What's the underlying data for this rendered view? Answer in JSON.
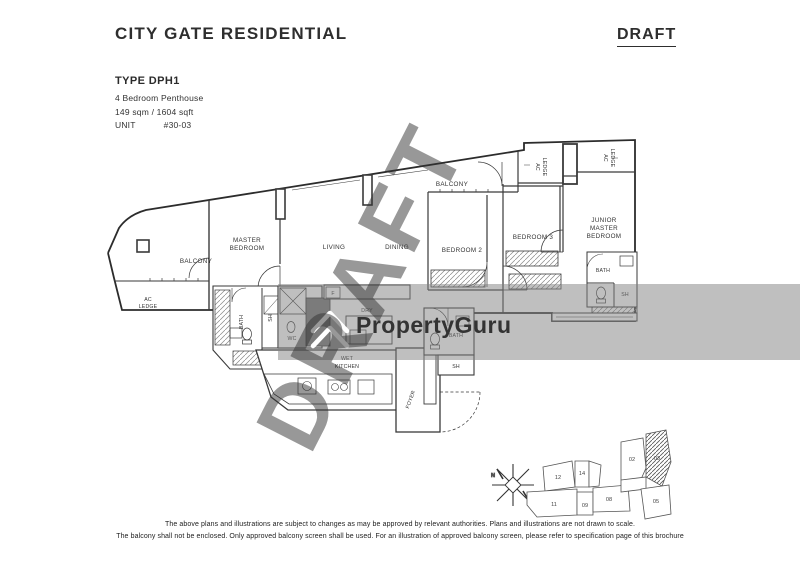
{
  "header": {
    "title": "CITY GATE RESIDENTIAL",
    "draft_label": "DRAFT"
  },
  "unit_info": {
    "type": "TYPE DPH1",
    "description": "4 Bedroom Penthouse",
    "area": "149 sqm / 1604 sqft",
    "unit_label": "UNIT",
    "unit_number": "#30-03"
  },
  "watermark": {
    "brand": "PropertyGuru",
    "draft": "DRAFT",
    "band_color": "#808080"
  },
  "plan": {
    "labels": {
      "balcony_left": "BALCONY",
      "ac_left_line1": "AC",
      "ac_left_line2": "LEDGE",
      "master_line1": "MASTER",
      "master_line2": "BEDROOM",
      "living": "LIVING",
      "dining": "DINING",
      "balcony_top": "BALCONY",
      "bedroom2": "BEDROOM 2",
      "bedroom3": "BEDROOM 3",
      "junior_line1": "JUNIOR",
      "junior_line2": "MASTER",
      "junior_line3": "BEDROOM",
      "ac_top1_line1": "AC",
      "ac_top1_line2": "LEDGE",
      "ac_top2_line1": "AC",
      "ac_top2_line2": "LEDGE",
      "bath_master": "BATH",
      "sh_master": "SH",
      "wc": "WC",
      "dry": "DRY",
      "wet_line1": "WET",
      "wet_line2": "KITCHEN",
      "bath_common": "BATH",
      "sh_common": "SH",
      "foyer": "FOYER",
      "bath_junior": "BATH",
      "sh_junior": "SH",
      "fridge": "F"
    }
  },
  "key_plan": {
    "north_label": "N",
    "units": {
      "u02": "02",
      "u03": "03",
      "u05": "05",
      "u08": "08",
      "u09": "09",
      "u11": "11",
      "u12": "12",
      "u14": "14"
    }
  },
  "disclaimer": {
    "line1": "The above plans and illustrations are subject to changes as may be approved by relevant authorities. Plans and illustrations are not drawn to scale.",
    "line2": "The balcony shall not be enclosed. Only approved balcony screen shall be used. For an illustration of approved balcony screen, please refer to specification page of this brochure"
  }
}
